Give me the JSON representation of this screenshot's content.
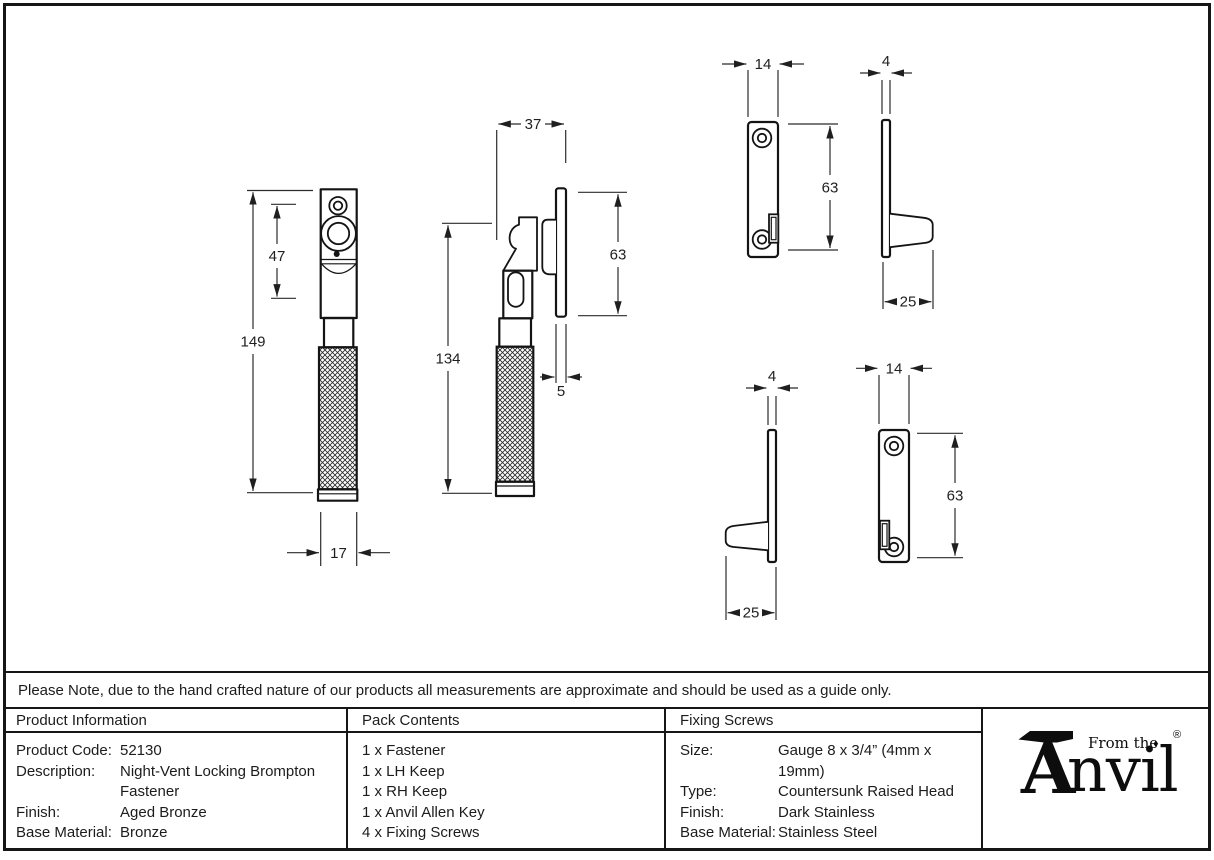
{
  "note": "Please Note, due to the hand crafted nature of our products all measurements are approximate and should be used as a guide only.",
  "table": {
    "product_information": {
      "header": "Product Information",
      "rows": [
        {
          "label": "Product Code:",
          "value": "52130"
        },
        {
          "label": "Description:",
          "value": "Night-Vent Locking Brompton Fastener"
        },
        {
          "label": "Finish:",
          "value": "Aged Bronze"
        },
        {
          "label": "Base Material:",
          "value": "Bronze"
        }
      ]
    },
    "pack_contents": {
      "header": "Pack Contents",
      "items": [
        "1 x Fastener",
        "1 x LH Keep",
        "1 x RH Keep",
        "1 x Anvil Allen Key",
        "4 x Fixing Screws"
      ]
    },
    "fixing_screws": {
      "header": "Fixing Screws",
      "rows": [
        {
          "label": "Size:",
          "value": "Gauge 8 x 3/4” (4mm x 19mm)"
        },
        {
          "label": "Type:",
          "value": "Countersunk Raised Head"
        },
        {
          "label": "Finish:",
          "value": "Dark Stainless"
        },
        {
          "label": "Base Material:",
          "value": "Stainless Steel"
        }
      ]
    }
  },
  "logo": {
    "tagline": "From the",
    "diamond": "♦",
    "brand_initial": "A",
    "brand_rest": "nvil",
    "registered": "®"
  },
  "dimensions": {
    "front_view": {
      "total_height": "149",
      "lock_body_height": "47",
      "width": "17"
    },
    "side_view": {
      "depth": "37",
      "body_height": "134",
      "keep_height": "63",
      "keep_thickness": "5"
    },
    "lh_keep": {
      "width": "14",
      "height": "63",
      "thickness": "4",
      "projection": "25"
    },
    "rh_keep": {
      "thickness": "4",
      "projection": "25",
      "width": "14",
      "height": "63"
    }
  },
  "colors": {
    "line": "#161616",
    "background": "#ffffff"
  }
}
